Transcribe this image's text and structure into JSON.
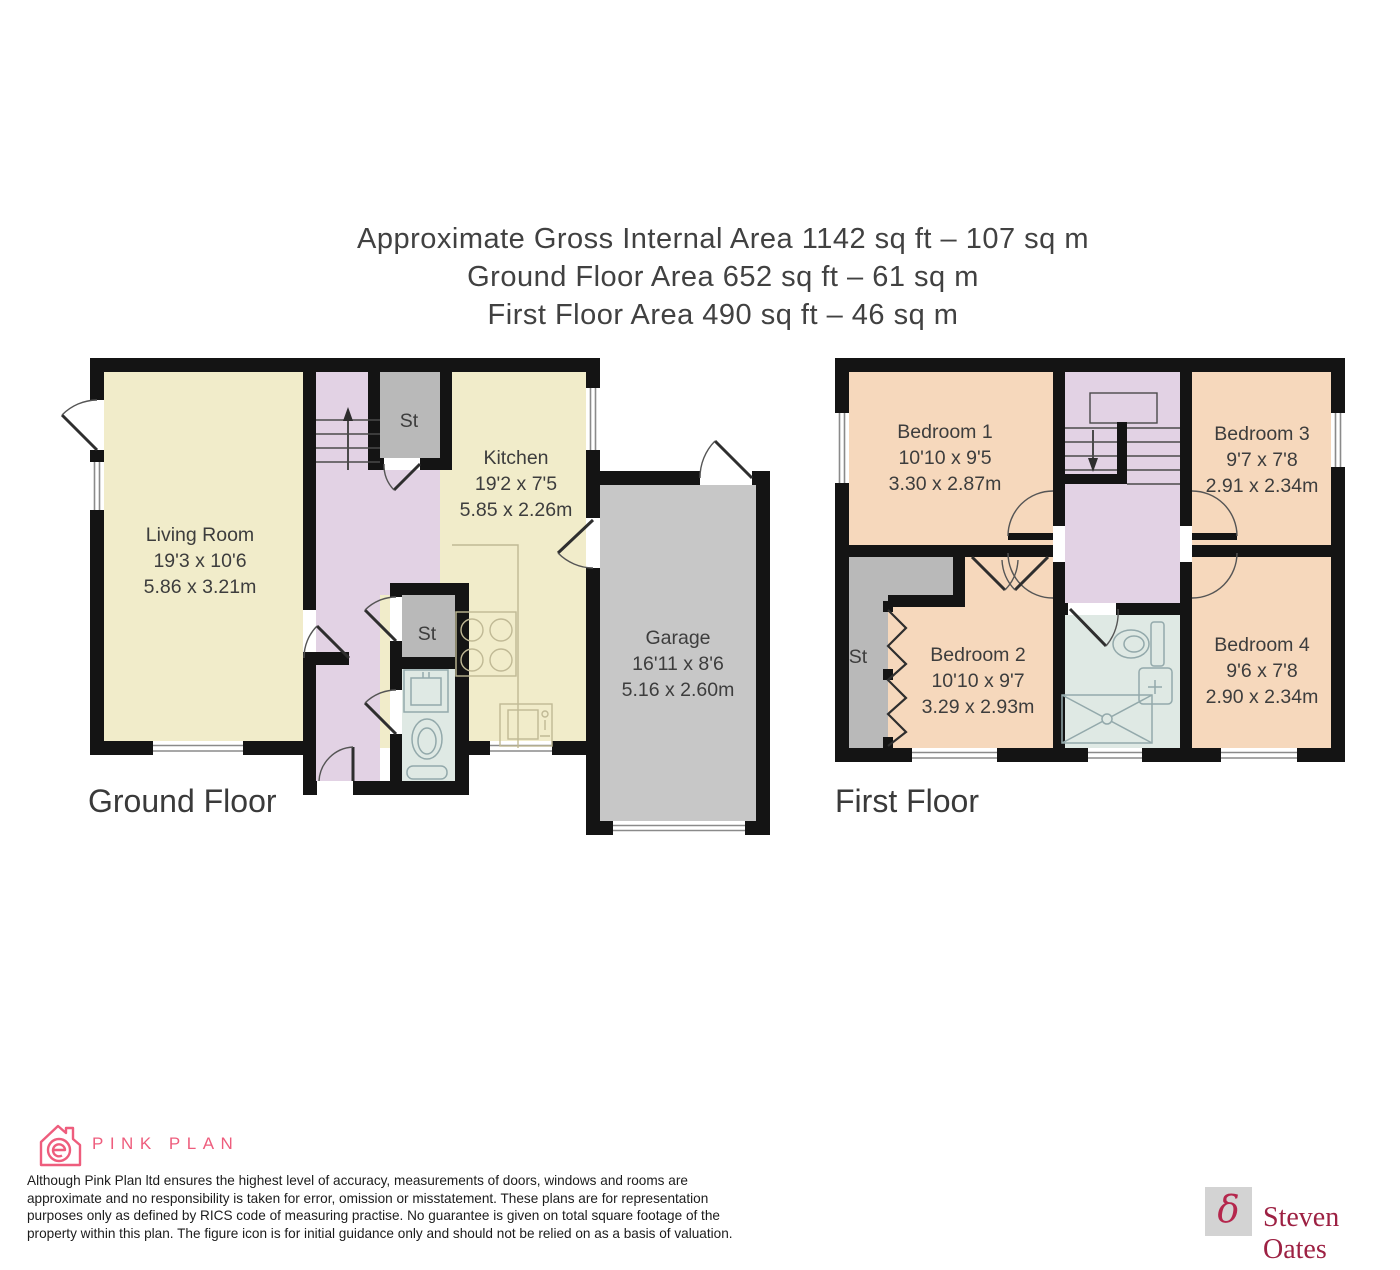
{
  "title": {
    "line1": "Approximate Gross Internal Area 1142 sq ft – 107 sq m",
    "line2": "Ground Floor Area 652 sq ft – 61 sq m",
    "line3": "First Floor Area 490 sq ft – 46 sq m"
  },
  "ground_floor": {
    "label": "Ground Floor",
    "rooms": {
      "living": {
        "name": "Living Room",
        "imperial": "19'3 x 10'6",
        "metric": "5.86 x 3.21m"
      },
      "kitchen": {
        "name": "Kitchen",
        "imperial": "19'2 x 7'5",
        "metric": "5.85 x 2.26m"
      },
      "garage": {
        "name": "Garage",
        "imperial": "16'11 x 8'6",
        "metric": "5.16 x 2.60m"
      },
      "st_top": "St",
      "st_mid": "St"
    }
  },
  "first_floor": {
    "label": "First Floor",
    "rooms": {
      "bedroom1": {
        "name": "Bedroom 1",
        "imperial": "10'10 x 9'5",
        "metric": "3.30 x 2.87m"
      },
      "bedroom2": {
        "name": "Bedroom 2",
        "imperial": "10'10 x 9'7",
        "metric": "3.29 x 2.93m"
      },
      "bedroom3": {
        "name": "Bedroom 3",
        "imperial": "9'7 x 7'8",
        "metric": "2.91 x 2.34m"
      },
      "bedroom4": {
        "name": "Bedroom 4",
        "imperial": "9'6 x 7'8",
        "metric": "2.90 x 2.34m"
      },
      "st": "St"
    }
  },
  "footer": {
    "brand": "PINK PLAN",
    "disclaimer_lines": [
      "Although Pink Plan ltd ensures the highest level of accuracy, measurements of doors, windows and rooms are",
      "approximate and no responsibility is taken for error, omission or misstatement. These plans are for representation",
      "purposes only as defined by RICS code of measuring practise. No guarantee is given on total square footage of the",
      "property within this plan. The figure icon is for initial guidance only and should not be relied on as a basis of valuation."
    ],
    "agency": "Steven Oates",
    "agency_glyph": "δ"
  },
  "colors": {
    "cream": "#f1ecca",
    "lavender": "#e2d2e4",
    "peach": "#f6d8bc",
    "storage_gray": "#b9b9b9",
    "garage_gray": "#c7c7c7",
    "bath_blue": "#dfe9e4",
    "wall": "#141414",
    "brand_pink": "#ee5d7d",
    "agency_maroon": "#9d2143"
  }
}
